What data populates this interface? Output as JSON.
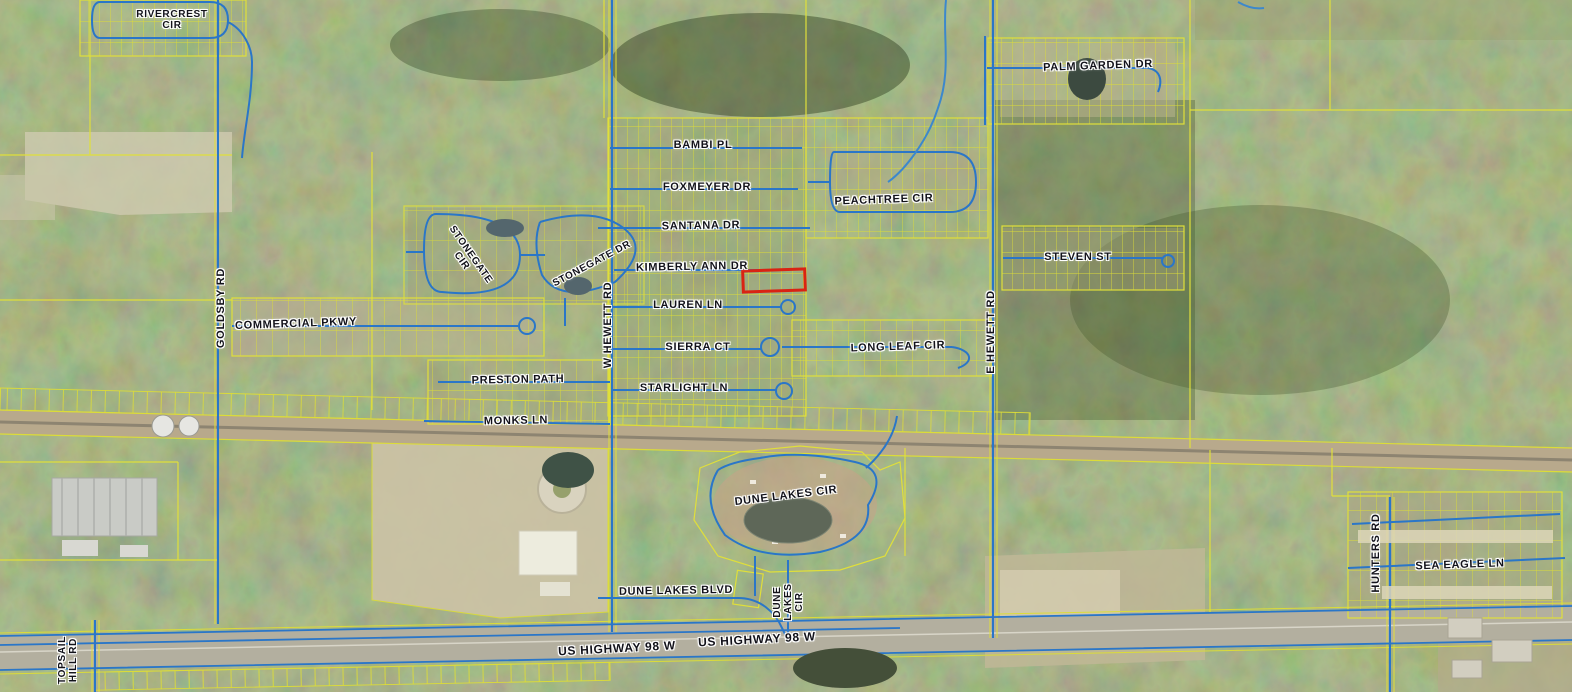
{
  "map": {
    "description": "County GIS aerial parcel map with road labels and one parcel highlighted in red",
    "colors": {
      "parcel_line": "#e0df3a",
      "road_line": "#2a76c8",
      "highlight_outline": "#d92313",
      "label_text": "#12121a",
      "railroad_corridor": "#b8a98c",
      "highway_pavement": "#b3af9f"
    },
    "highlighted_parcel": {
      "x": 743,
      "y": 270,
      "w": 62,
      "h": 21,
      "rot": -2,
      "outline": "#d92313"
    },
    "labels": [
      {
        "id": "rivercrest-cir",
        "lines": [
          "RIVERCREST",
          "CIR"
        ],
        "x": 172,
        "y": 20,
        "rot": 0,
        "size": 10
      },
      {
        "id": "palm-garden-dr",
        "lines": [
          "PALM GARDEN DR"
        ],
        "x": 1098,
        "y": 66,
        "rot": -2
      },
      {
        "id": "bambi-pl",
        "lines": [
          "BAMBI PL"
        ],
        "x": 703,
        "y": 145,
        "rot": 0
      },
      {
        "id": "foxmeyer-dr",
        "lines": [
          "FOXMEYER DR"
        ],
        "x": 707,
        "y": 187,
        "rot": 0
      },
      {
        "id": "peachtree-cir",
        "lines": [
          "PEACHTREE CIR"
        ],
        "x": 884,
        "y": 200,
        "rot": -2
      },
      {
        "id": "santana-dr",
        "lines": [
          "SANTANA DR"
        ],
        "x": 701,
        "y": 226,
        "rot": -1
      },
      {
        "id": "stonegate-cir",
        "lines": [
          "STONEGATE",
          "CIR"
        ],
        "x": 466,
        "y": 258,
        "rot": 55,
        "size": 10
      },
      {
        "id": "stonegate-dr",
        "lines": [
          "STONEGATE DR"
        ],
        "x": 592,
        "y": 264,
        "rot": -28,
        "size": 10
      },
      {
        "id": "kimberly-ann-dr",
        "lines": [
          "KIMBERLY ANN DR"
        ],
        "x": 692,
        "y": 267,
        "rot": -1
      },
      {
        "id": "steven-st",
        "lines": [
          "STEVEN ST"
        ],
        "x": 1078,
        "y": 257,
        "rot": 0
      },
      {
        "id": "lauren-ln",
        "lines": [
          "LAUREN LN"
        ],
        "x": 688,
        "y": 305,
        "rot": 0
      },
      {
        "id": "commercial-pkwy",
        "lines": [
          "COMMERCIAL PKWY"
        ],
        "x": 296,
        "y": 324,
        "rot": -2
      },
      {
        "id": "goldsby-rd",
        "lines": [
          "GOLDSBY RD"
        ],
        "x": 221,
        "y": 308,
        "rot": -90
      },
      {
        "id": "w-hewett-rd",
        "lines": [
          "W HEWETT RD"
        ],
        "x": 608,
        "y": 325,
        "rot": -90
      },
      {
        "id": "e-hewett-rd",
        "lines": [
          "E HEWETT RD"
        ],
        "x": 991,
        "y": 332,
        "rot": -90
      },
      {
        "id": "sierra-ct",
        "lines": [
          "SIERRA CT"
        ],
        "x": 698,
        "y": 347,
        "rot": 0
      },
      {
        "id": "long-leaf-cir",
        "lines": [
          "LONG LEAF CIR"
        ],
        "x": 898,
        "y": 347,
        "rot": -2
      },
      {
        "id": "preston-path",
        "lines": [
          "PRESTON PATH"
        ],
        "x": 518,
        "y": 380,
        "rot": -1
      },
      {
        "id": "starlight-ln",
        "lines": [
          "STARLIGHT LN"
        ],
        "x": 684,
        "y": 388,
        "rot": 0
      },
      {
        "id": "monks-ln",
        "lines": [
          "MONKS LN"
        ],
        "x": 516,
        "y": 421,
        "rot": -1
      },
      {
        "id": "dune-lakes-cir",
        "lines": [
          "DUNE LAKES CIR"
        ],
        "x": 786,
        "y": 496,
        "rot": -7
      },
      {
        "id": "hunters-rd",
        "lines": [
          "HUNTERS RD"
        ],
        "x": 1376,
        "y": 553,
        "rot": -90
      },
      {
        "id": "sea-eagle-ln",
        "lines": [
          "SEA EAGLE LN"
        ],
        "x": 1460,
        "y": 565,
        "rot": -2
      },
      {
        "id": "dune-lakes-blvd",
        "lines": [
          "DUNE LAKES BLVD"
        ],
        "x": 676,
        "y": 591,
        "rot": -1
      },
      {
        "id": "dune-lakes-cir-vertical",
        "lines": [
          "DUNE",
          "LAKES",
          "CIR"
        ],
        "x": 789,
        "y": 602,
        "rot": -90,
        "size": 10
      },
      {
        "id": "us-highway-98-w-left",
        "lines": [
          "US HIGHWAY 98 W"
        ],
        "x": 617,
        "y": 649,
        "rot": -3,
        "size": 12
      },
      {
        "id": "us-highway-98-w-right",
        "lines": [
          "US HIGHWAY 98 W"
        ],
        "x": 757,
        "y": 640,
        "rot": -3,
        "size": 12
      },
      {
        "id": "topsail-hill-rd",
        "lines": [
          "TOPSAIL",
          "HILL RD"
        ],
        "x": 68,
        "y": 660,
        "rot": -90,
        "size": 10
      }
    ]
  }
}
